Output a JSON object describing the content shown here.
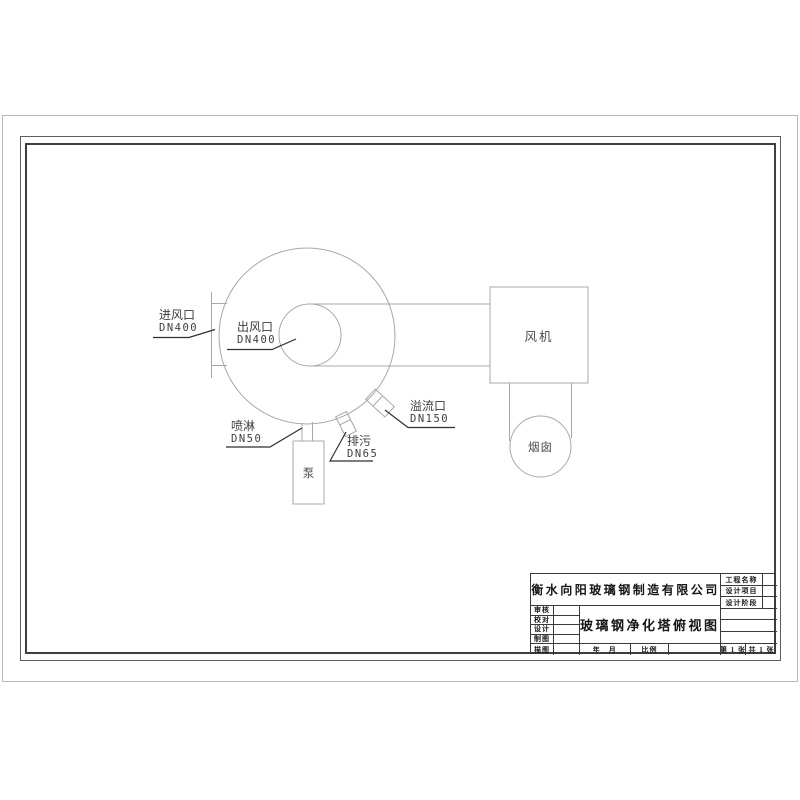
{
  "drawing": {
    "labels": {
      "inlet_name": "进风口",
      "inlet_dn": "DN400",
      "outlet_name": "出风口",
      "outlet_dn": "DN400",
      "overflow_name": "溢流口",
      "overflow_dn": "DN150",
      "drain_name": "排污",
      "drain_dn": "DN65",
      "spray_name": "喷淋",
      "spray_dn": "DN50",
      "pump": "泵",
      "fan": "风机",
      "chimney": "烟囱"
    }
  },
  "title_block": {
    "company": "衡水向阳玻璃钢制造有限公司",
    "drawing_title": "玻璃钢净化塔俯视图",
    "sign_rows": [
      "审核",
      "校对",
      "设计",
      "制图",
      "描图"
    ],
    "project_rows": [
      "工程名称",
      "设计项目",
      "设计阶段"
    ],
    "date_label": "年　月",
    "scale_label": "比例",
    "sheet_label": "第 1 张",
    "total_label": "共 1 张"
  },
  "colors": {
    "drawing_line": "#a8a8a8",
    "leader_line": "#2f2f2f",
    "table_line": "#3a3a3a",
    "frame_line": "#3f3f3f",
    "paper_edge": "#b8b8b8",
    "text": "#3d3d3d"
  }
}
